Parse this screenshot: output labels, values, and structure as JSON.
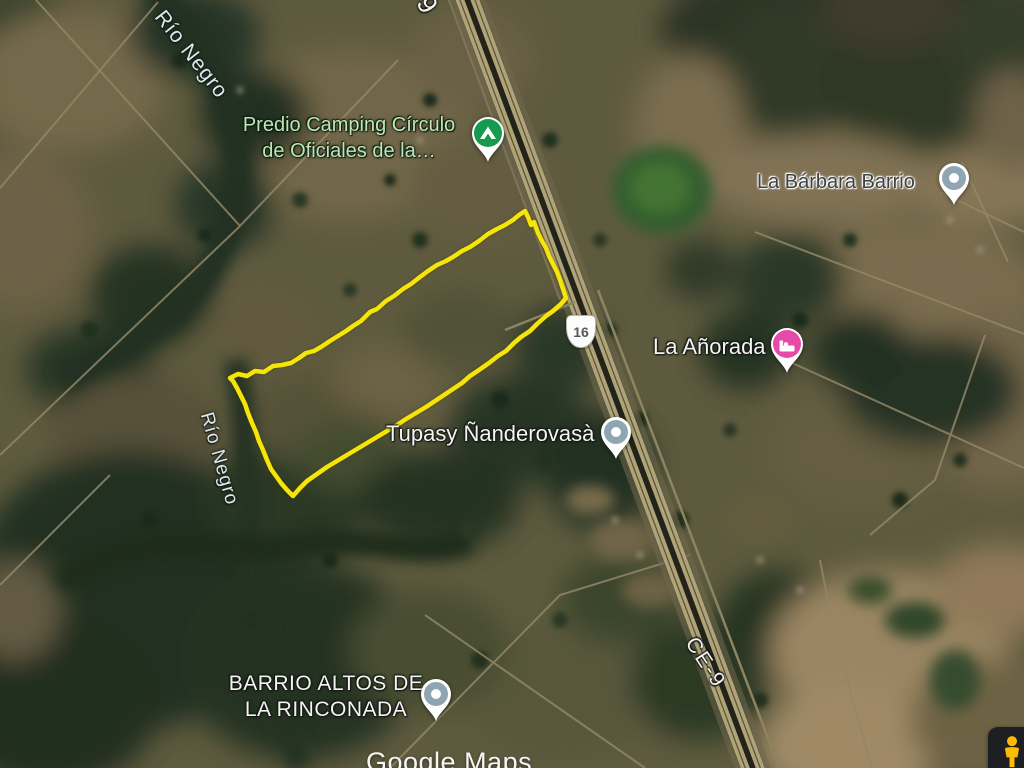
{
  "map": {
    "view": "satellite",
    "watermark": "Google Maps",
    "water_labels": {
      "top": "Río Negro",
      "left": "Río Negro"
    },
    "route_shield": {
      "value": "16"
    },
    "road_labels": {
      "top_partial": "9",
      "frontage": "CE-9"
    },
    "places": {
      "camping": {
        "line1": "Predio Camping Círculo",
        "line2": "de Oficiales de la…",
        "icon": "campground-icon",
        "pin_color": "#169a4e"
      },
      "barbara": {
        "label": "La Bárbara Barrio",
        "icon": "place-pin-icon",
        "pin_color": "#8fa6b2"
      },
      "anorada": {
        "label": "La Añorada",
        "icon": "hotel-pin-icon",
        "pin_color": "#e64aa8"
      },
      "tupasy": {
        "label": "Tupasy Ñanderovasà",
        "icon": "place-pin-icon",
        "pin_color": "#8fa6b2"
      },
      "barrio_altos": {
        "line1": "BARRIO ALTOS DE",
        "line2": "LA RINCONADA",
        "icon": "place-pin-icon",
        "pin_color": "#8fa6b2"
      }
    },
    "parcel_outline": {
      "color": "#f5e50a",
      "points": "230,378 238,374 247,376 255,371 264,372 273,366 282,365 291,363 299,358 306,353 314,351 321,347 330,341 338,336 346,331 353,326 361,321 370,312 377,309 386,301 394,296 403,289 411,284 420,277 428,271 437,265 446,261 453,257 462,251 470,247 479,241 488,234 497,229 505,225 513,220 519,215 525,211 528,217 531,225 534,222 538,233 542,241 546,248 549,256 553,264 557,272 560,280 563,289 566,298 561,304 553,311 546,316 537,324 530,331 521,337 514,343 506,351 498,356 489,363 479,370 470,376 462,383 453,389 444,395 435,401 426,407 416,413 406,419 397,425 387,431 377,437 367,443 357,449 347,455 337,461 327,467 317,474 307,481 300,488 293,496 287,490 281,483 276,476 271,469 267,460 263,450 259,441 256,432 252,423 248,413 245,404 241,396 237,388 233,381 230,378"
    },
    "pegman_color": "#fcbc02"
  }
}
